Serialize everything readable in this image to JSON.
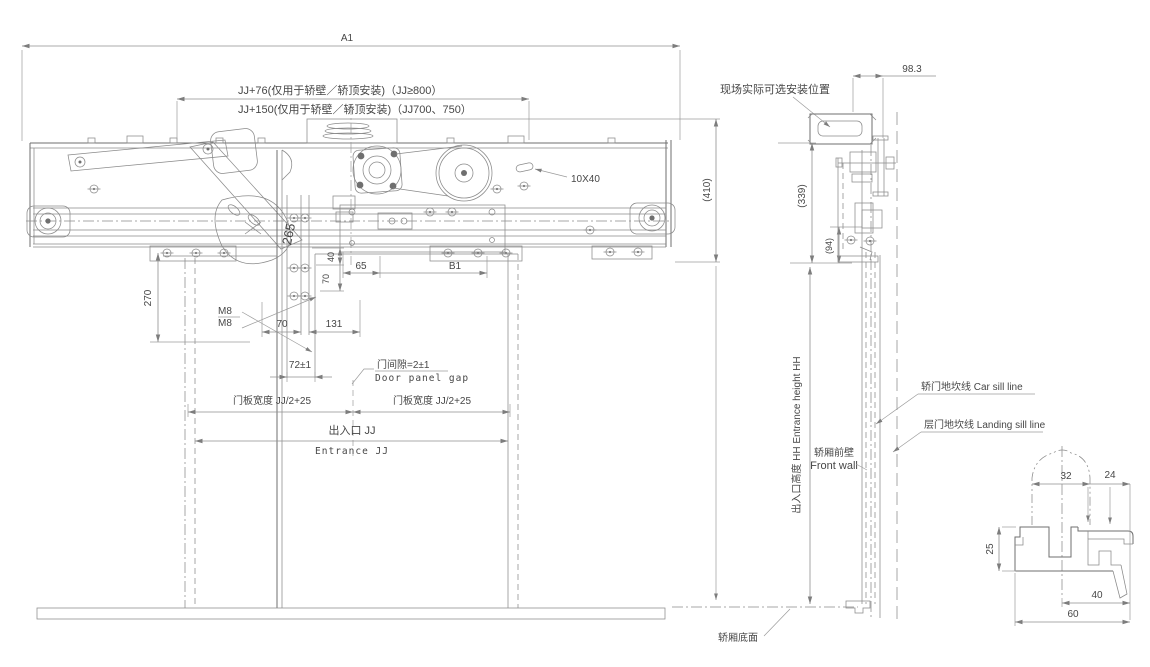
{
  "drawing": {
    "front_view": {
      "dim_a1": "A1",
      "dim_jj76": "JJ+76(仅用于轿壁／轿顶安装)（JJ≥800）",
      "dim_jj150": "JJ+150(仅用于轿壁／轿顶安装)（JJ700、750）",
      "dim_410": "(410)",
      "dim_270": "270",
      "dim_265": "265",
      "label_m8_1": "M8",
      "label_m8_2": "M8",
      "dim_70a": "70",
      "dim_131": "131",
      "dim_72": "72±1",
      "dim_40": "40",
      "dim_70b": "70",
      "dim_65": "65",
      "dim_b1": "B1",
      "label_slot": "10X40",
      "label_gap_cn": "门间隙=2±1",
      "label_gap_en": "Door panel gap",
      "label_panel_width_left": "门板宽度 JJ/2+25",
      "label_panel_width_right": "门板宽度 JJ/2+25",
      "label_entrance_cn": "出入口 JJ",
      "label_entrance_en": "Entrance JJ"
    },
    "side_view": {
      "label_install": "现场实际可选安装位置",
      "dim_983": "98.3",
      "dim_339": "(339)",
      "dim_94": "(94)",
      "dim_hh": "出入口高度 HH Entrance height HH",
      "label_car_sill": "轿门地坎线 Car sill line",
      "label_landing_sill": "层门地坎线 Landing sill line",
      "label_front_wall_cn": "轿厢前壁",
      "label_front_wall_en": "Front wall",
      "label_car_bottom": "轿厢底面"
    },
    "sill_detail": {
      "dim_32": "32",
      "dim_24": "24",
      "dim_25": "25",
      "dim_40": "40",
      "dim_60": "60"
    },
    "colors": {
      "line": "#6f6f6f",
      "dim_line": "#8f8f8f",
      "text": "#474747",
      "background": "#ffffff"
    }
  }
}
